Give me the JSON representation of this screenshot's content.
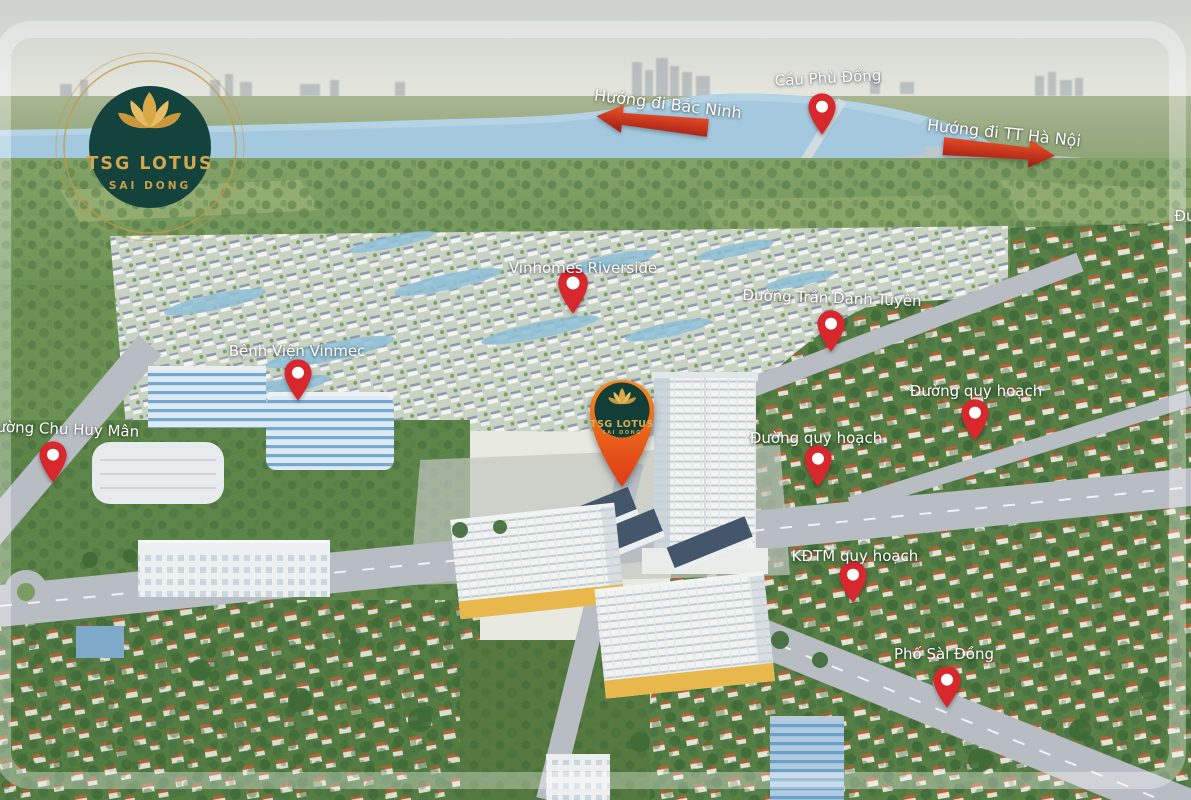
{
  "logo": {
    "title": "TSG LOTUS",
    "subtitle": "SAI DONG",
    "pos": {
      "x": 45,
      "y": 42
    }
  },
  "project_marker": {
    "title": "TSG LOTUS",
    "subtitle": "SAI DONG",
    "pin": {
      "x": 622,
      "y": 489
    }
  },
  "arrows": [
    {
      "label": "Hướng đi Bắc Ninh",
      "direction": "left",
      "label_pos": {
        "x": 668,
        "y": 104,
        "rot": 7
      },
      "arrow_pos": {
        "x": 652,
        "y": 124,
        "rot": 6
      }
    },
    {
      "label": "Hướng đi TT Hà Nội",
      "direction": "right",
      "label_pos": {
        "x": 1004,
        "y": 133,
        "rot": 6
      },
      "arrow_pos": {
        "x": 999,
        "y": 153,
        "rot": 5
      }
    }
  ],
  "markers": [
    {
      "label": "Cầu Phù Đổng",
      "pin": {
        "x": 822,
        "y": 140
      },
      "label_pos": {
        "x": 828,
        "y": 78,
        "rot": -3
      }
    },
    {
      "label": "Vinhomes Riverside",
      "pin": {
        "x": 573,
        "y": 319
      },
      "label_pos": {
        "x": 583,
        "y": 268,
        "rot": 0
      }
    },
    {
      "label": "Đường Trần Danh Tuyên",
      "pin": {
        "x": 831,
        "y": 357
      },
      "label_pos": {
        "x": 832,
        "y": 298,
        "rot": 2
      }
    },
    {
      "label": "Bệnh Viện Vinmec",
      "pin": {
        "x": 298,
        "y": 406
      },
      "label_pos": {
        "x": 297,
        "y": 351,
        "rot": 0
      }
    },
    {
      "label": "Đường Chu Huy Mân",
      "pin": {
        "x": 53,
        "y": 488
      },
      "label_pos": {
        "x": 62,
        "y": 429,
        "rot": 2
      }
    },
    {
      "label": "Đường quy hoạch",
      "pin": {
        "x": 818,
        "y": 492
      },
      "label_pos": {
        "x": 816,
        "y": 438,
        "rot": 0
      }
    },
    {
      "label": "Đường quy hoạch",
      "pin": {
        "x": 975,
        "y": 446
      },
      "label_pos": {
        "x": 976,
        "y": 391,
        "rot": 0
      }
    },
    {
      "label": "KĐTM quy hoạch",
      "pin": {
        "x": 853,
        "y": 608
      },
      "label_pos": {
        "x": 855,
        "y": 556,
        "rot": 0
      }
    },
    {
      "label": "Phố Sài Đồng",
      "pin": {
        "x": 947,
        "y": 713
      },
      "label_pos": {
        "x": 944,
        "y": 654,
        "rot": 0
      }
    }
  ],
  "partial_label": {
    "label": "Đường",
    "pos": {
      "x": 1199,
      "y": 216,
      "rot": 0
    }
  },
  "colors": {
    "pin_red": "#d7282e",
    "label_text": "#ffffff",
    "logo_teal": "#14433d",
    "logo_gold": "#cfa14b",
    "project_pin_orange": "#ee6a22",
    "arrow_red": "#e03a20",
    "river_blue": "#a4c9de"
  }
}
